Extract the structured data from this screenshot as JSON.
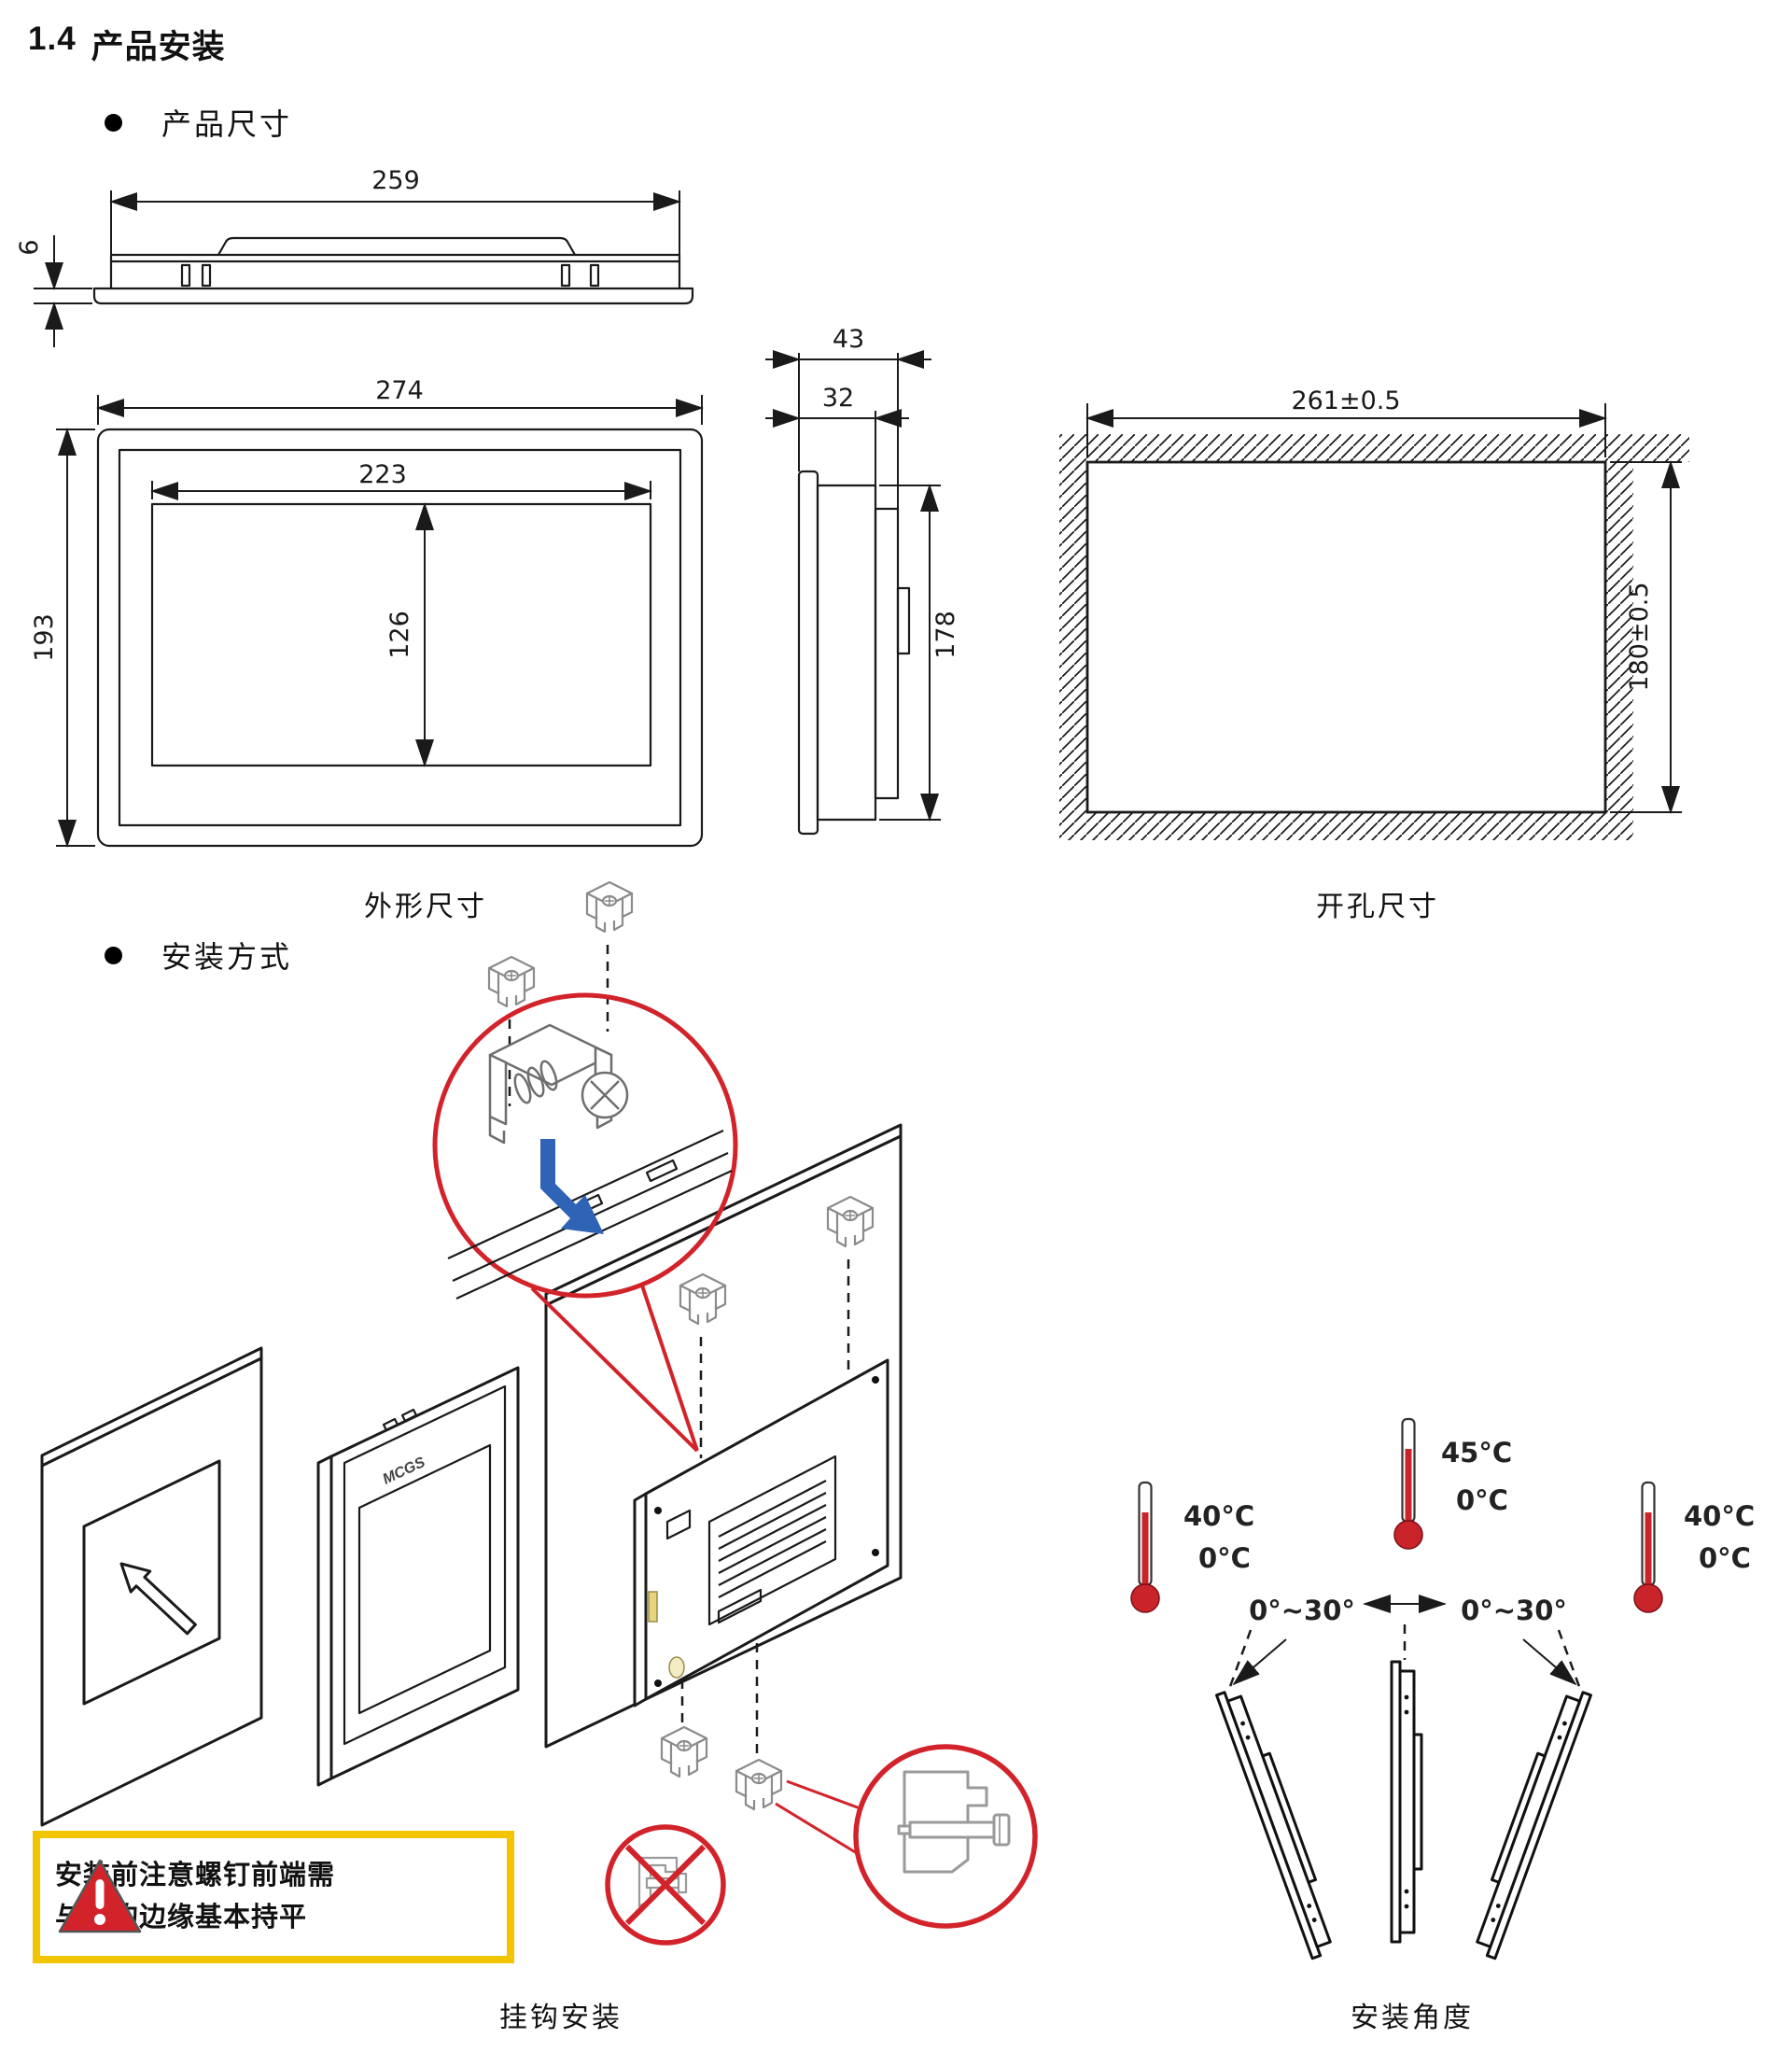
{
  "page": {
    "section_no": "1.4",
    "section_title": "产品安装",
    "bullets": {
      "dimensions": "产品尺寸",
      "installation": "安装方式"
    },
    "captions": {
      "outline": "外形尺寸",
      "cutout": "开孔尺寸",
      "hook": "挂钩安装",
      "angle": "安装角度"
    }
  },
  "outline_view": {
    "top_width": "259",
    "front_lip": "6",
    "outer_width": "274",
    "display_width": "223",
    "outer_height": "193",
    "display_height": "126",
    "depth_total": "43",
    "depth_body": "32",
    "side_height": "178"
  },
  "cutout_view": {
    "width": "261±0.5",
    "height": "180±0.5"
  },
  "hook_view": {
    "logo": "MCGS",
    "warning_line1": "安装前注意螺钉前端需",
    "warning_line2": "与挂钩边缘基本持平"
  },
  "angle_view": {
    "left_high": "40°C",
    "left_low": "0°C",
    "center_high": "45°C",
    "center_low": "0°C",
    "right_high": "40°C",
    "right_low": "0°C",
    "range_left": "0°~30°",
    "range_right": "0°~30°"
  },
  "colors": {
    "accent_red": "#d2232a",
    "arrow_blue": "#2e63b5",
    "warning_yellow": "#f2c500"
  }
}
